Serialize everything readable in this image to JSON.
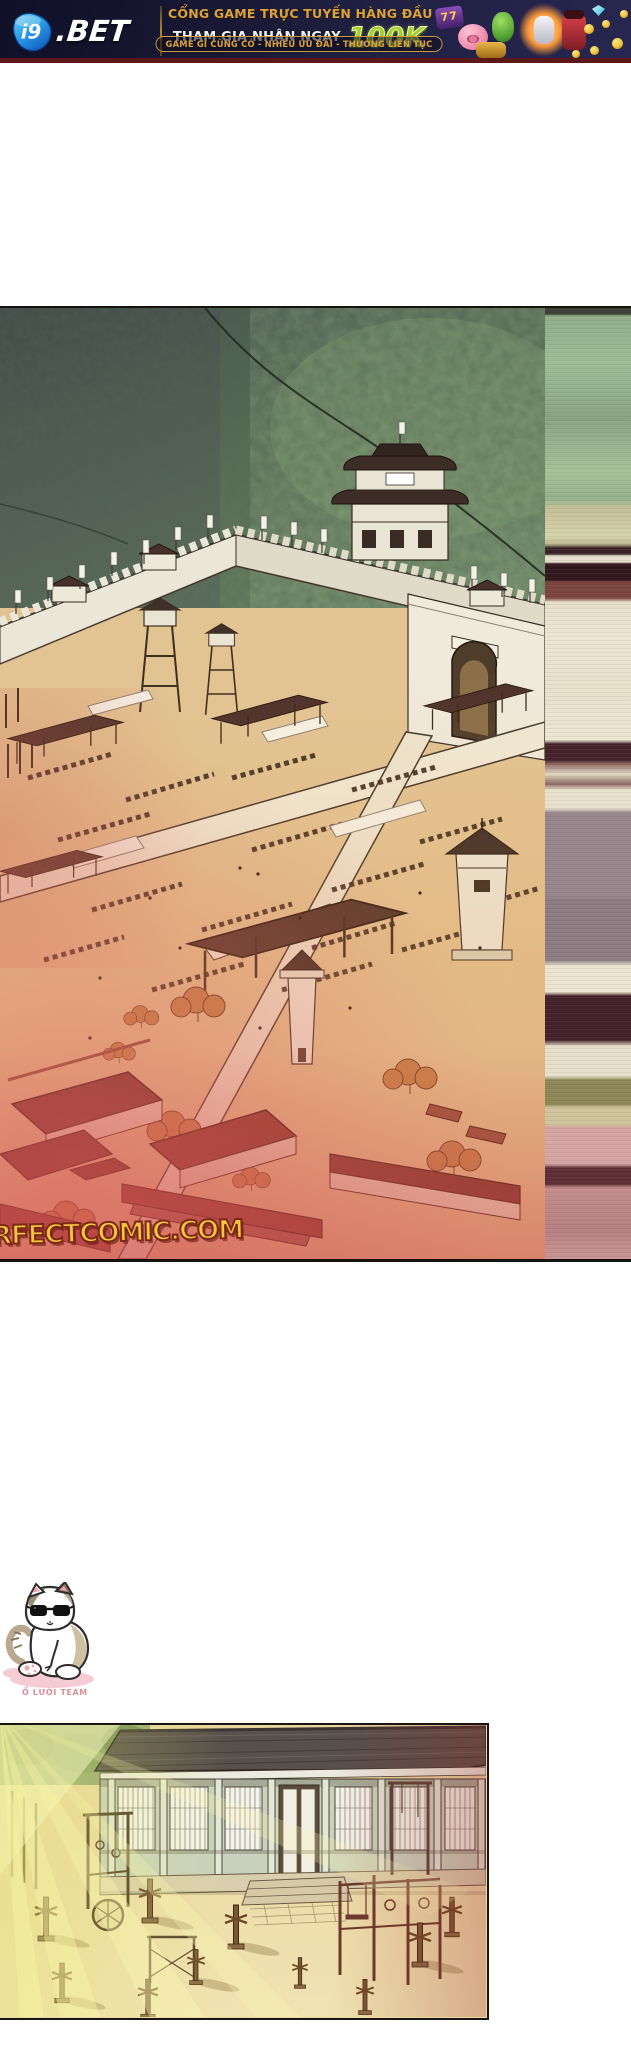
{
  "banner": {
    "logo_prefix": "i9",
    "logo_suffix": ".BET",
    "headline": "CỔNG GAME TRỰC TUYẾN HÀNG ĐẦU",
    "cta_text": "THAM GIA NHẬN NGAY",
    "cta_amount": "100K",
    "tagline": "GAME GÌ CŨNG CÓ - NHIỀU ƯU ĐÃI - THƯỞNG LIÊN TỤC",
    "slot_sevens": "77",
    "colors": {
      "background": "#16162f",
      "headline_gold": "#d9a23c",
      "amount_green": "#a9cf2d",
      "logo_blue": "#2b9fe8",
      "bottom_strip": "#5c1818"
    }
  },
  "comic": {
    "watermark": "RFECTCOMIC.COM",
    "watermark_color": "#f2c63e",
    "mascot_caption": "Ổ LƯỜI TEAM",
    "mascot_caption_color": "#d9909a"
  }
}
